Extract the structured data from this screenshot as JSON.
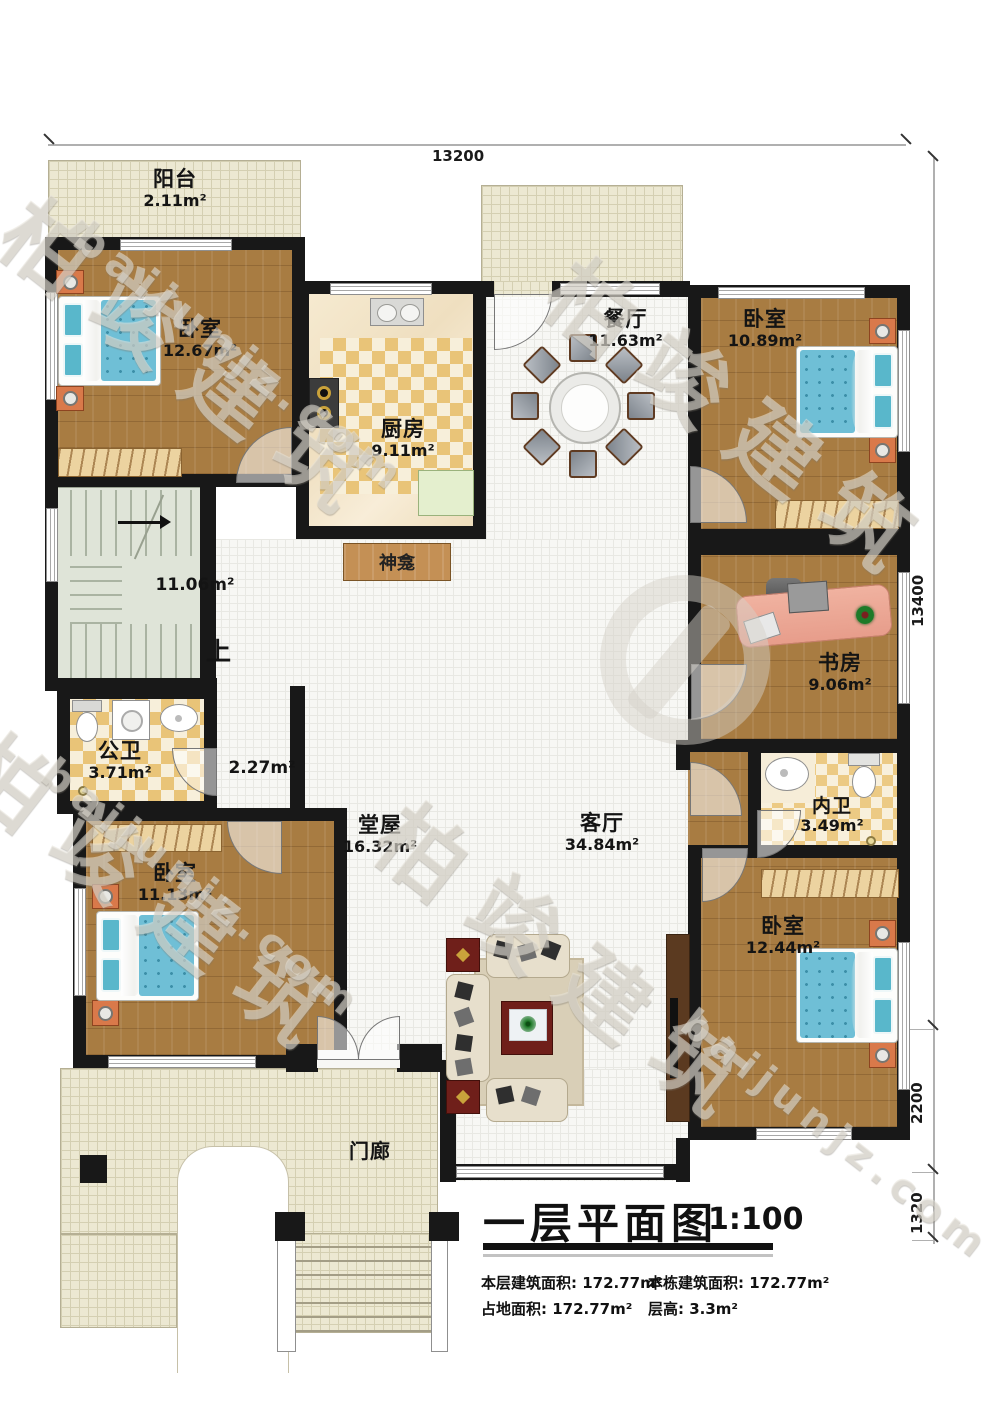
{
  "plan": {
    "dims": {
      "top": "13200",
      "right": "13400",
      "right2": "2200",
      "right3": "1320"
    },
    "rooms": {
      "balcony": {
        "name": "阳台",
        "area": "2.11m²"
      },
      "bedroomTL": {
        "name": "卧室",
        "area": "12.67m²"
      },
      "kitchen": {
        "name": "厨房",
        "area": "9.11m²"
      },
      "dining": {
        "name": "餐厅",
        "area": "11.63m²"
      },
      "bedroomTR": {
        "name": "卧室",
        "area": "10.89m²"
      },
      "stairs": {
        "area": "11.06m²",
        "up": "上"
      },
      "shrine": {
        "name": "神龛"
      },
      "study": {
        "name": "书房",
        "area": "9.06m²"
      },
      "publicBath": {
        "name": "公卫",
        "area": "3.71m²"
      },
      "corridor": {
        "area": "2.27m²"
      },
      "hall": {
        "name": "堂屋",
        "area": "16.32m²"
      },
      "living": {
        "name": "客厅",
        "area": "34.84m²"
      },
      "innerBath": {
        "name": "内卫",
        "area": "3.49m²"
      },
      "bedroomBL": {
        "name": "卧室",
        "area": "11.13m²"
      },
      "bedroomBR": {
        "name": "卧室",
        "area": "12.44m²"
      },
      "porch": {
        "name": "门廊"
      }
    },
    "title": {
      "text": "一层平面图",
      "scale": "1:100"
    },
    "stats": {
      "s1_label": "本层建筑面积:",
      "s1_value": "172.77m²",
      "s2_label": "本栋建筑面积:",
      "s2_value": "172.77m²",
      "s3_label": "占地面积:",
      "s3_value": "172.77m²",
      "s4_label": "层高:",
      "s4_value": "3.3m²"
    },
    "watermark": {
      "brand": "柏竣建筑",
      "site": "baijunjz.com"
    },
    "colors": {
      "wall": "#181818",
      "wood_floor": "#a87c42",
      "bed_blue": "#6fbfd6",
      "bath_tile": "#e9c478",
      "outdoor": "#ece8d2",
      "accent_table": "#6f1f1a"
    }
  }
}
